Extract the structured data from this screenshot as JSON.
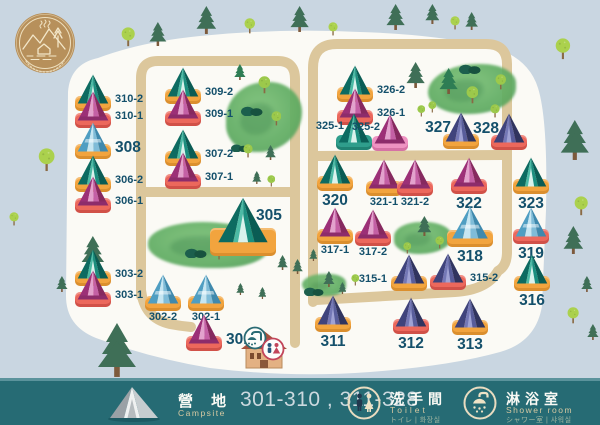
{
  "legend": {
    "campsite": {
      "zh": "營 地",
      "en": "Campsite",
      "range": "301-310 , 311-328"
    },
    "toilet": {
      "zh": "洗手間",
      "en": "Toilet",
      "sub": "トイレ | 화장실"
    },
    "shower": {
      "zh": "淋浴室",
      "en": "Shower room",
      "sub": "シャワー室 | 샤워실"
    }
  },
  "colors": {
    "background": "#c9d6e1",
    "map_area": "#fbfaf5",
    "road": "#dcc79c",
    "bar": "#266b74",
    "label_text": "#14506b",
    "base_orange": "#f2a43e",
    "base_red": "#ec685c",
    "base_teal": "#2f9e8c",
    "base_pink": "#ee93c2",
    "tent_palettes": {
      "teal": [
        "#0d6b61",
        "#4cbaa5",
        "#1b8e7e",
        "#0a5c54",
        "#d9f2ec"
      ],
      "pink": [
        "#9c3077",
        "#e3a2cd",
        "#c460a5",
        "#86295f",
        "#8d2c6b"
      ],
      "blue": [
        "#4f9ec2",
        "#c6e6f2",
        "#7fbcd8",
        "#3f89ad",
        "#ffffff"
      ],
      "purple": [
        "#3f437c",
        "#7478b6",
        "#585d9b",
        "#30345f",
        "#9fa2d4"
      ]
    }
  },
  "map": {
    "tents": [
      {
        "id": "310-2",
        "x": 93,
        "y": 111,
        "t": "teal",
        "b": "orange",
        "lp": "right"
      },
      {
        "id": "310-1",
        "x": 93,
        "y": 128,
        "t": "pink",
        "b": "red",
        "lp": "right"
      },
      {
        "id": "308",
        "x": 93,
        "y": 159,
        "t": "blue",
        "b": "orange",
        "lp": "right",
        "ls": "b"
      },
      {
        "id": "306-2",
        "x": 93,
        "y": 192,
        "t": "teal",
        "b": "orange",
        "lp": "right"
      },
      {
        "id": "306-1",
        "x": 93,
        "y": 213,
        "t": "pink",
        "b": "red",
        "lp": "right"
      },
      {
        "id": "303-2",
        "x": 93,
        "y": 286,
        "t": "teal",
        "b": "orange",
        "lp": "right"
      },
      {
        "id": "303-1",
        "x": 93,
        "y": 307,
        "t": "pink",
        "b": "red",
        "lp": "right"
      },
      {
        "id": "309-2",
        "x": 183,
        "y": 104,
        "t": "teal",
        "b": "orange",
        "lp": "right"
      },
      {
        "id": "309-1",
        "x": 183,
        "y": 126,
        "t": "pink",
        "b": "red",
        "lp": "right"
      },
      {
        "id": "307-2",
        "x": 183,
        "y": 166,
        "t": "teal",
        "b": "orange",
        "lp": "right"
      },
      {
        "id": "307-1",
        "x": 183,
        "y": 189,
        "t": "pink",
        "b": "red",
        "lp": "right"
      },
      {
        "id": "305",
        "x": 243,
        "y": 256,
        "t": "teal",
        "b": "orange",
        "lp": "topright",
        "ls": "b",
        "sz": "lg"
      },
      {
        "id": "302-2",
        "x": 163,
        "y": 311,
        "t": "blue",
        "b": "orange",
        "lp": "below"
      },
      {
        "id": "302-1",
        "x": 206,
        "y": 311,
        "t": "blue",
        "b": "orange",
        "lp": "below"
      },
      {
        "id": "301",
        "x": 204,
        "y": 351,
        "t": "pink",
        "b": "red",
        "lp": "right",
        "ls": "b"
      },
      {
        "id": "326-2",
        "x": 355,
        "y": 102,
        "t": "teal",
        "b": "orange",
        "lp": "right"
      },
      {
        "id": "326-1",
        "x": 355,
        "y": 125,
        "t": "pink",
        "b": "red",
        "lp": "right"
      },
      {
        "id": "325-1",
        "x": 354,
        "y": 150,
        "t": "teal",
        "b": "teal",
        "lp": "topleft"
      },
      {
        "id": "325-2",
        "x": 390,
        "y": 151,
        "t": "pink",
        "b": "pink",
        "lp": "topleft"
      },
      {
        "id": "327",
        "x": 461,
        "y": 149,
        "t": "purple",
        "b": "orange",
        "lp": "topleft",
        "ls": "b"
      },
      {
        "id": "328",
        "x": 509,
        "y": 150,
        "t": "purple",
        "b": "red",
        "lp": "topleft",
        "ls": "b"
      },
      {
        "id": "320",
        "x": 335,
        "y": 191,
        "t": "teal",
        "b": "orange",
        "lp": "below",
        "ls": "b"
      },
      {
        "id": "321-1",
        "x": 384,
        "y": 196,
        "t": "pink",
        "b": "orange",
        "lp": "below"
      },
      {
        "id": "321-2",
        "x": 415,
        "y": 196,
        "t": "pink",
        "b": "red",
        "lp": "below"
      },
      {
        "id": "322",
        "x": 469,
        "y": 194,
        "t": "pink",
        "b": "red",
        "lp": "below",
        "ls": "b"
      },
      {
        "id": "323",
        "x": 531,
        "y": 194,
        "t": "teal",
        "b": "orange",
        "lp": "below",
        "ls": "b"
      },
      {
        "id": "317-1",
        "x": 335,
        "y": 244,
        "t": "pink",
        "b": "orange",
        "lp": "below"
      },
      {
        "id": "317-2",
        "x": 373,
        "y": 246,
        "t": "pink",
        "b": "red",
        "lp": "below"
      },
      {
        "id": "318",
        "x": 470,
        "y": 247,
        "t": "blue",
        "b": "orange",
        "lp": "below",
        "ls": "b",
        "sz": "md"
      },
      {
        "id": "319",
        "x": 531,
        "y": 244,
        "t": "blue",
        "b": "red",
        "lp": "below",
        "ls": "b"
      },
      {
        "id": "315-1",
        "x": 409,
        "y": 291,
        "t": "purple",
        "b": "orange",
        "lp": "left"
      },
      {
        "id": "315-2",
        "x": 448,
        "y": 290,
        "t": "purple",
        "b": "red",
        "lp": "right"
      },
      {
        "id": "316",
        "x": 532,
        "y": 291,
        "t": "teal",
        "b": "orange",
        "lp": "below",
        "ls": "b"
      },
      {
        "id": "311",
        "x": 333,
        "y": 332,
        "t": "purple",
        "b": "orange",
        "lp": "below",
        "ls": "b"
      },
      {
        "id": "312",
        "x": 411,
        "y": 334,
        "t": "purple",
        "b": "red",
        "lp": "below",
        "ls": "b"
      },
      {
        "id": "313",
        "x": 470,
        "y": 335,
        "t": "purple",
        "b": "orange",
        "lp": "below",
        "ls": "b"
      }
    ],
    "trees": [
      {
        "k": "round",
        "x": 128,
        "y": 47,
        "h": 20
      },
      {
        "k": "pine",
        "x": 158,
        "y": 46,
        "h": 24
      },
      {
        "k": "pine",
        "x": 206,
        "y": 34,
        "h": 28
      },
      {
        "k": "round",
        "x": 250,
        "y": 34,
        "h": 16
      },
      {
        "k": "pine",
        "x": 300,
        "y": 32,
        "h": 26
      },
      {
        "k": "round",
        "x": 333,
        "y": 36,
        "h": 14
      },
      {
        "k": "pine",
        "x": 396,
        "y": 30,
        "h": 26
      },
      {
        "k": "pine",
        "x": 432,
        "y": 24,
        "h": 20
      },
      {
        "k": "round",
        "x": 455,
        "y": 30,
        "h": 14
      },
      {
        "k": "pine",
        "x": 472,
        "y": 30,
        "h": 18
      },
      {
        "k": "round",
        "x": 563,
        "y": 60,
        "h": 22
      },
      {
        "k": "round",
        "x": 47,
        "y": 172,
        "h": 24
      },
      {
        "k": "round",
        "x": 14,
        "y": 226,
        "h": 14
      },
      {
        "k": "pine",
        "x": 62,
        "y": 292,
        "h": 16
      },
      {
        "k": "pine",
        "x": 117,
        "y": 377,
        "h": 54
      },
      {
        "k": "pine",
        "x": 575,
        "y": 160,
        "h": 40
      },
      {
        "k": "round",
        "x": 581,
        "y": 216,
        "h": 20
      },
      {
        "k": "pine",
        "x": 573,
        "y": 254,
        "h": 28
      },
      {
        "k": "pine",
        "x": 587,
        "y": 292,
        "h": 16
      },
      {
        "k": "round",
        "x": 573,
        "y": 324,
        "h": 17
      },
      {
        "k": "pine",
        "x": 593,
        "y": 340,
        "h": 16
      },
      {
        "k": "pine",
        "x": 93,
        "y": 268,
        "h": 32
      },
      {
        "k": "bush",
        "x": 252,
        "y": 114,
        "h": 11
      },
      {
        "k": "bush",
        "x": 240,
        "y": 148,
        "h": 9
      },
      {
        "k": "round",
        "x": 264,
        "y": 94,
        "h": 18,
        "c": 1
      },
      {
        "k": "round",
        "x": 276,
        "y": 126,
        "h": 15,
        "c": 1
      },
      {
        "k": "round",
        "x": 248,
        "y": 158,
        "h": 14,
        "c": 1
      },
      {
        "k": "pine",
        "x": 240,
        "y": 80,
        "h": 16,
        "c": 1
      },
      {
        "k": "pine",
        "x": 271,
        "y": 160,
        "h": 15
      },
      {
        "k": "pine",
        "x": 257,
        "y": 184,
        "h": 13
      },
      {
        "k": "round",
        "x": 271,
        "y": 186,
        "h": 12,
        "c": 1
      },
      {
        "k": "pine",
        "x": 416,
        "y": 88,
        "h": 26
      },
      {
        "k": "round",
        "x": 421,
        "y": 116,
        "h": 12,
        "c": 1
      },
      {
        "k": "bush",
        "x": 470,
        "y": 72,
        "h": 11
      },
      {
        "k": "pine",
        "x": 449,
        "y": 94,
        "h": 26,
        "c": 1
      },
      {
        "k": "round",
        "x": 472,
        "y": 104,
        "h": 18,
        "c": 1
      },
      {
        "k": "round",
        "x": 501,
        "y": 90,
        "h": 16,
        "c": 1
      },
      {
        "k": "round",
        "x": 495,
        "y": 118,
        "h": 14,
        "c": 1
      },
      {
        "k": "round",
        "x": 432,
        "y": 112,
        "h": 12,
        "c": 1
      },
      {
        "k": "round",
        "x": 230,
        "y": 252,
        "h": 18,
        "c": 1
      },
      {
        "k": "round",
        "x": 219,
        "y": 260,
        "h": 14,
        "c": 1
      },
      {
        "k": "bush",
        "x": 196,
        "y": 256,
        "h": 11
      },
      {
        "k": "bush",
        "x": 254,
        "y": 252,
        "h": 10
      },
      {
        "k": "pine",
        "x": 283,
        "y": 270,
        "h": 15
      },
      {
        "k": "pine",
        "x": 298,
        "y": 274,
        "h": 15
      },
      {
        "k": "pine",
        "x": 313,
        "y": 260,
        "h": 12
      },
      {
        "k": "pine",
        "x": 240,
        "y": 294,
        "h": 12
      },
      {
        "k": "pine",
        "x": 262,
        "y": 298,
        "h": 12
      },
      {
        "k": "pine",
        "x": 424,
        "y": 236,
        "h": 20
      },
      {
        "k": "round",
        "x": 440,
        "y": 249,
        "h": 13,
        "c": 1
      },
      {
        "k": "round",
        "x": 407,
        "y": 253,
        "h": 12,
        "c": 1
      },
      {
        "k": "bush",
        "x": 314,
        "y": 293,
        "h": 10
      },
      {
        "k": "pine",
        "x": 329,
        "y": 287,
        "h": 16
      },
      {
        "k": "pine",
        "x": 342,
        "y": 293,
        "h": 12
      },
      {
        "k": "round",
        "x": 355,
        "y": 285,
        "h": 12,
        "c": 1
      }
    ],
    "forests": [
      {
        "x": 226,
        "y": 82,
        "w": 76,
        "h": 70,
        "r": "55% 45% 60% 40%"
      },
      {
        "x": 148,
        "y": 222,
        "w": 120,
        "h": 46,
        "r": "50% 60% 45% 55%"
      },
      {
        "x": 428,
        "y": 64,
        "w": 88,
        "h": 50,
        "r": "60% 40% 55% 45%"
      },
      {
        "x": 394,
        "y": 222,
        "w": 58,
        "h": 32,
        "r": "50% 50% 60% 45%"
      },
      {
        "x": 302,
        "y": 274,
        "w": 44,
        "h": 22,
        "r": "55% 45% 50% 60%"
      }
    ]
  }
}
